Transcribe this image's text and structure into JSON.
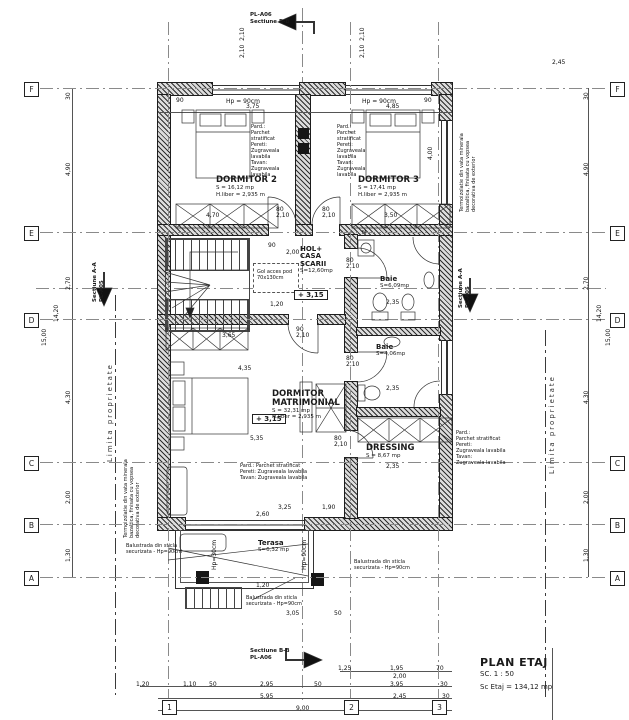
{
  "drawing": {
    "title": "PLAN ETAJ",
    "scale": "SC. 1 : 50",
    "area_total": "Sc Etaj = 134,12 mp"
  },
  "axes": {
    "rows": [
      {
        "label": "F",
        "y": 88
      },
      {
        "label": "E",
        "y": 232
      },
      {
        "label": "D",
        "y": 319
      },
      {
        "label": "C",
        "y": 462
      },
      {
        "label": "B",
        "y": 524
      },
      {
        "label": "A",
        "y": 577
      }
    ],
    "cols": [
      {
        "label": "1",
        "x": 168
      },
      {
        "label": "2",
        "x": 350
      },
      {
        "label": "3",
        "x": 438
      }
    ]
  },
  "rooms": [
    {
      "name": "DORMITOR 2",
      "lines": [
        "S = 16,12 mp",
        "H.liber = 2,935 m"
      ],
      "x": 216,
      "y": 176
    },
    {
      "name": "DORMITOR 3",
      "lines": [
        "S = 17,41 mp",
        "H.liber = 2,935 m"
      ],
      "x": 358,
      "y": 176
    },
    {
      "name": "HOL+\nCASA\nSCARII",
      "lines": [
        "S=12,60mp"
      ],
      "x": 300,
      "y": 246,
      "small": true
    },
    {
      "name": "Baie",
      "lines": [
        "S=6,09mp"
      ],
      "x": 380,
      "y": 276,
      "small": true
    },
    {
      "name": "Baie",
      "lines": [
        "S=4,06mp"
      ],
      "x": 376,
      "y": 344,
      "small": true
    },
    {
      "name": "DORMITOR\nMATRIMONIAL",
      "lines": [
        "S = 32,31 mp",
        "H.liber = 2,935 m"
      ],
      "x": 272,
      "y": 390
    },
    {
      "name": "DRESSING",
      "lines": [
        "S = 8,67 mp"
      ],
      "x": 366,
      "y": 444
    },
    {
      "name": "Terasa",
      "lines": [
        "S=6,32 mp"
      ],
      "x": 258,
      "y": 540,
      "small": true
    }
  ],
  "levels": [
    {
      "t": "+ 3,15",
      "x": 294,
      "y": 290
    },
    {
      "t": "+ 3,15",
      "x": 252,
      "y": 414
    }
  ],
  "notes": [
    {
      "t": "Pard.:\nParchet\nstratificat\nPereti:\nZugraveala\nlavabila\nTavan:\nZugraveala\nlavabila",
      "x": 251,
      "y": 124
    },
    {
      "t": "Pard.:\nParchet\nstratificat\nPereti:\nZugraveala\nlavabila\nTavan:\nZugraveala\nlavabila",
      "x": 337,
      "y": 124
    },
    {
      "t": "Pard.: Parchet stratificat\nPereti: Zugraveala lavabila\nTavan: Zugraveala lavabila",
      "x": 240,
      "y": 463
    },
    {
      "t": "Pard.:\nParchet stratificat\nPereti:\nZugraveala lavabila\nTavan:\nZugraveala lavabila",
      "x": 456,
      "y": 430
    }
  ],
  "annotations": [
    {
      "t": "Limita proprietate",
      "x": 106,
      "y": 462,
      "r": -90,
      "cls": "prop-text"
    },
    {
      "t": "Limita proprietate",
      "x": 548,
      "y": 474,
      "r": -90,
      "cls": "prop-text"
    },
    {
      "t": "Termoizolatie din vata minerala\nbazaltica, finisata cu vopsea\ndecorativa de exterior",
      "x": 124,
      "y": 538,
      "r": -90
    },
    {
      "t": "Termoizolatie din vata minerala\nbazaltica, finisata cu vopsea\ndecorativa de exterior",
      "x": 460,
      "y": 212,
      "r": -90
    },
    {
      "t": "Balustrada din sticla\nsecurizata - Hp=90cm",
      "x": 126,
      "y": 544
    },
    {
      "t": "Balustrada din sticla\nsecurizata - Hp=90cm",
      "x": 354,
      "y": 560
    },
    {
      "t": "Balustrada din sticla\nsecurizata - Hp=90cm",
      "x": 246,
      "y": 596
    },
    {
      "t": "Gol acces pod\n70x130cm",
      "x": 257,
      "y": 270
    },
    {
      "t": "M",
      "x": 362,
      "y": 231
    }
  ],
  "sections": [
    {
      "l1": "PL-A06",
      "l2": "Sectiune B-B",
      "x": 250,
      "y": 12
    },
    {
      "l1": "Sectiune B-B",
      "l2": "PL-A06",
      "x": 250,
      "y": 648
    },
    {
      "l1": "Sectiune A-A",
      "l2": "PL-A05",
      "x": 92,
      "y": 302,
      "r": -90
    },
    {
      "l1": "Sectiune A-A",
      "l2": "PL-A05",
      "x": 458,
      "y": 308,
      "r": -90
    }
  ],
  "dims": [
    {
      "t": "3,75",
      "x": 246,
      "y": 104
    },
    {
      "t": "4,85",
      "x": 386,
      "y": 104
    },
    {
      "t": "90",
      "x": 176,
      "y": 98
    },
    {
      "t": "90",
      "x": 424,
      "y": 98
    },
    {
      "t": "Hp = 90cm",
      "x": 226,
      "y": 99
    },
    {
      "t": "Hp = 90cm",
      "x": 362,
      "y": 99
    },
    {
      "t": "2,10  2,10",
      "x": 240,
      "y": 58,
      "r": -90
    },
    {
      "t": "2,10  2,10",
      "x": 360,
      "y": 58,
      "r": -90
    },
    {
      "t": "2,45",
      "x": 552,
      "y": 60
    },
    {
      "t": "30",
      "x": 66,
      "y": 100,
      "r": -90
    },
    {
      "t": "4,90",
      "x": 66,
      "y": 176,
      "r": -90
    },
    {
      "t": "2,70",
      "x": 66,
      "y": 290,
      "r": -90
    },
    {
      "t": "4,30",
      "x": 66,
      "y": 404,
      "r": -90
    },
    {
      "t": "2,00",
      "x": 66,
      "y": 504,
      "r": -90
    },
    {
      "t": "1,30",
      "x": 66,
      "y": 562,
      "r": -90
    },
    {
      "t": "14,20",
      "x": 54,
      "y": 322,
      "r": -90
    },
    {
      "t": "15,00",
      "x": 42,
      "y": 346,
      "r": -90
    },
    {
      "t": "30",
      "x": 584,
      "y": 100,
      "r": -90
    },
    {
      "t": "4,90",
      "x": 584,
      "y": 176,
      "r": -90
    },
    {
      "t": "2,70",
      "x": 584,
      "y": 290,
      "r": -90
    },
    {
      "t": "4,30",
      "x": 584,
      "y": 404,
      "r": -90
    },
    {
      "t": "2,00",
      "x": 584,
      "y": 504,
      "r": -90
    },
    {
      "t": "1,30",
      "x": 584,
      "y": 562,
      "r": -90
    },
    {
      "t": "14,20",
      "x": 597,
      "y": 322,
      "r": -90
    },
    {
      "t": "15,00",
      "x": 606,
      "y": 346,
      "r": -90
    },
    {
      "t": "1,25",
      "x": 338,
      "y": 666
    },
    {
      "t": "1,95",
      "x": 390,
      "y": 666
    },
    {
      "t": "70",
      "x": 436,
      "y": 666
    },
    {
      "t": "2,00",
      "x": 393,
      "y": 674
    },
    {
      "t": "1,20",
      "x": 136,
      "y": 682
    },
    {
      "t": "1,10",
      "x": 183,
      "y": 682
    },
    {
      "t": "50",
      "x": 209,
      "y": 682
    },
    {
      "t": "2,95",
      "x": 260,
      "y": 682
    },
    {
      "t": "50",
      "x": 314,
      "y": 682
    },
    {
      "t": "3,95",
      "x": 390,
      "y": 682
    },
    {
      "t": "30",
      "x": 440,
      "y": 682
    },
    {
      "t": "5,95",
      "x": 260,
      "y": 694
    },
    {
      "t": "2,45",
      "x": 393,
      "y": 694
    },
    {
      "t": "30",
      "x": 442,
      "y": 694
    },
    {
      "t": "9,00",
      "x": 296,
      "y": 706
    },
    {
      "t": "4,70",
      "x": 206,
      "y": 213
    },
    {
      "t": "3,50",
      "x": 384,
      "y": 213
    },
    {
      "t": "90",
      "x": 268,
      "y": 243
    },
    {
      "t": "2,00",
      "x": 286,
      "y": 250
    },
    {
      "t": "80\n2,10",
      "x": 276,
      "y": 207
    },
    {
      "t": "80\n2,10",
      "x": 322,
      "y": 207
    },
    {
      "t": "80\n2,10",
      "x": 346,
      "y": 258
    },
    {
      "t": "80\n2,10",
      "x": 346,
      "y": 356
    },
    {
      "t": "90\n2,10",
      "x": 296,
      "y": 327
    },
    {
      "t": "80\n2,10",
      "x": 334,
      "y": 436
    },
    {
      "t": "1,20",
      "x": 270,
      "y": 302
    },
    {
      "t": "3,65",
      "x": 222,
      "y": 333
    },
    {
      "t": "4,35",
      "x": 238,
      "y": 366
    },
    {
      "t": "5,35",
      "x": 250,
      "y": 436
    },
    {
      "t": "2,35",
      "x": 386,
      "y": 300
    },
    {
      "t": "2,35",
      "x": 386,
      "y": 386
    },
    {
      "t": "2,35",
      "x": 386,
      "y": 464
    },
    {
      "t": "4,00",
      "x": 428,
      "y": 160,
      "r": -90
    },
    {
      "t": "3,25",
      "x": 278,
      "y": 505
    },
    {
      "t": "2,60",
      "x": 256,
      "y": 512
    },
    {
      "t": "1,90",
      "x": 322,
      "y": 505
    },
    {
      "t": "1,20",
      "x": 256,
      "y": 583
    },
    {
      "t": "3,05",
      "x": 286,
      "y": 611
    },
    {
      "t": "50",
      "x": 334,
      "y": 611
    },
    {
      "t": "Hp=90cm",
      "x": 302,
      "y": 570,
      "r": -90
    },
    {
      "t": "Hp=30cm",
      "x": 212,
      "y": 570,
      "r": -90
    }
  ]
}
